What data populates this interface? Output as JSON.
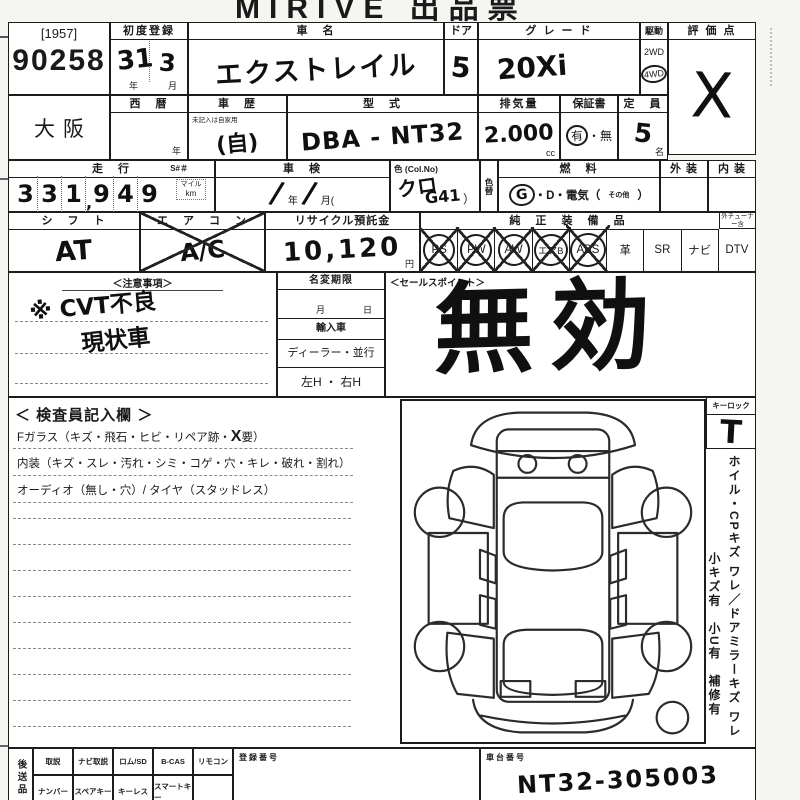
{
  "title": "MIRIVE 出品票",
  "lot": {
    "bracket": "[1957]",
    "number": "90258"
  },
  "row1": {
    "first_reg": {
      "label": "初度登録",
      "year": "31",
      "month": "3",
      "year_unit": "年",
      "month_unit": "月"
    },
    "car_name": {
      "label": "車　名",
      "value": "エクストレイル"
    },
    "door": {
      "label": "ドア",
      "value": "5"
    },
    "grade": {
      "label": "グ レ ー ド",
      "value": "20Xi"
    },
    "drive": {
      "label": "駆動",
      "option_2wd": "2WD",
      "option_4wd": "4WD",
      "selected": "4WD"
    },
    "score": {
      "label": "評 価 点",
      "value": "X"
    }
  },
  "row2": {
    "auction_house": "大阪",
    "seireki": {
      "label": "西　暦",
      "unit": "年"
    },
    "history": {
      "label": "車　歴",
      "note": "未記入は自家用",
      "value": "(自)"
    },
    "model_code": {
      "label": "型　式",
      "value": "DBA - NT32"
    },
    "displacement": {
      "label": "排気量",
      "value": "2.000",
      "unit": "cc"
    },
    "warranty": {
      "label": "保証書",
      "yes": "有",
      "sep": "・",
      "no": "無",
      "selected": "有"
    },
    "capacity": {
      "label": "定　員",
      "value": "5",
      "unit": "名"
    }
  },
  "row3": {
    "mileage": {
      "label": "走　行",
      "s_label": "S#＃",
      "digits": [
        "3",
        "3",
        "1",
        "9",
        "4",
        "9"
      ],
      "comma": ",",
      "unit_top": "マイル",
      "unit_bottom": "km"
    },
    "shaken": {
      "label": "車　検",
      "strike1": "∕",
      "year_unit": "年",
      "strike2": "∕",
      "month_unit": "月("
    },
    "color": {
      "label": "色 (Col.No)",
      "value": "クロ",
      "code": "G41",
      "close": "）"
    },
    "color_change_label": "色替",
    "fuel": {
      "label": "燃　料",
      "g": "G",
      "rest": "・D・電気（",
      "other": "その他",
      "close": "）",
      "selected": "G"
    },
    "exterior_label": "外 装",
    "interior_label": "内 装"
  },
  "row4": {
    "shift": {
      "label": "シ　フ　ト",
      "value": "AT"
    },
    "aircon": {
      "label": "エ　ア　コ　ン",
      "value": "A/C",
      "crossed_out": true
    },
    "recycle": {
      "label": "リサイクル預託金",
      "value": "10,120",
      "unit": "円"
    },
    "equipment": {
      "label": "純 正 装 備 品",
      "tuner_note": "外チューナー含",
      "items": [
        {
          "label": "PS",
          "marked": true
        },
        {
          "label": "PW",
          "marked": true
        },
        {
          "label": "AW",
          "marked": true
        },
        {
          "label": "エアB",
          "marked": true
        },
        {
          "label": "ABS",
          "marked": true
        },
        {
          "label": "革",
          "marked": false
        },
        {
          "label": "SR",
          "marked": false
        },
        {
          "label": "ナビ",
          "marked": false
        },
        {
          "label": "DTV",
          "marked": false
        }
      ]
    }
  },
  "notes": {
    "header": "＜注意事項＞",
    "line1": "※ CVT不良",
    "line2": "現状車"
  },
  "name_change": {
    "header": "名変期限",
    "month_unit": "月",
    "day_unit": "日",
    "import_label": "輸入車",
    "dealer_label": "ディーラー・並行",
    "handle_label": "左H ・ 右H"
  },
  "sales_point": {
    "header": "＜セールスポイント＞",
    "stamp": "無効"
  },
  "inspector": {
    "header": "＜ 検査員記入欄 ＞",
    "fglass_prefix": "Fガラス（キズ・飛石・ヒビ・リペア跡・",
    "fglass_mark": "X",
    "fglass_suffix": "要）",
    "interior_line": "内装（キズ・スレ・汚れ・シミ・コゲ・穴・キレ・破れ・割れ）",
    "audio_line": "オーディオ（無し・穴）/ タイヤ（スタッドレス）"
  },
  "key_lock": {
    "label": "キーロック",
    "value": "T"
  },
  "side_note": {
    "line1": "ホイル・CPキズ ワレ／ドアミラーキズ ワレ",
    "line2": "小キズ有　小U有　補修有"
  },
  "bottom": {
    "send_later_label": "後送品",
    "row1_items": [
      "取説",
      "ナビ取説",
      "ロム/SD",
      "B-CAS",
      "リモコン"
    ],
    "row2_items": [
      "ナンバー",
      "スペアキー",
      "キーレス",
      "スマートキー"
    ],
    "reg_no_label": "登録番号",
    "chassis": {
      "label": "車台番号",
      "value": "NT32-305003"
    }
  }
}
